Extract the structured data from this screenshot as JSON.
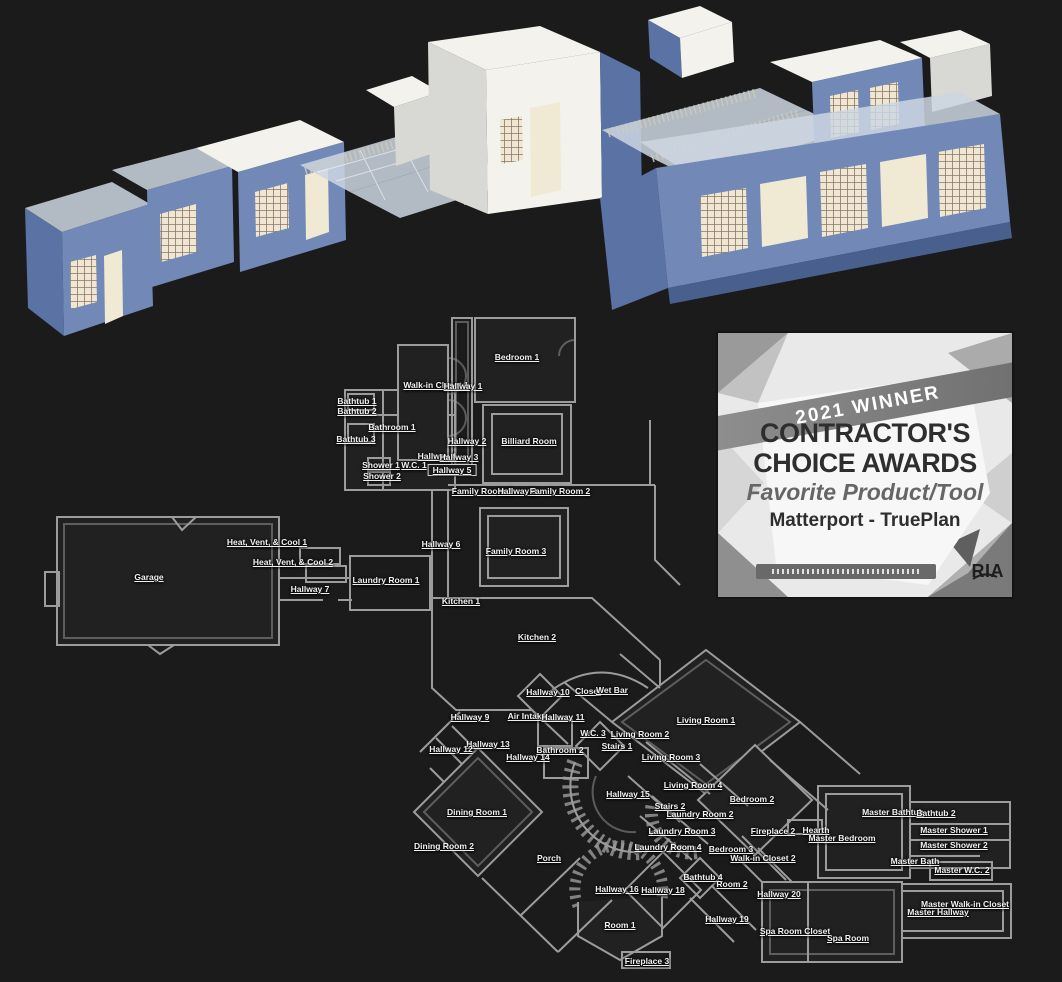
{
  "palette": {
    "bg": "#1b1b1b",
    "plan_line": "#9c9c9c",
    "label": "#f1f1f1",
    "wall_blue": "#7289b8",
    "wall_blue_dark": "#5a72a4",
    "wall_blue_deep": "#49608f",
    "roof_white": "#f3f2ec",
    "roof_glass": "#ccd6e2",
    "interior_cream": "#f0e9d4",
    "lattice_brown": "#8d7668",
    "badge_text": "#2e2e2e",
    "badge_sub": "#666666"
  },
  "badge": {
    "banner": "2021 WINNER",
    "title_line1": "CONTRACTOR'S",
    "title_line2": "CHOICE AWARDS",
    "category": "Favorite Product/Tool",
    "winner": "Matterport - TruePlan",
    "logo": "RIA"
  },
  "floorplan": {
    "labels": [
      {
        "t": "Bedroom 1",
        "x": 517,
        "y": 357
      },
      {
        "t": "Walk-in Closet 1",
        "x": 436,
        "y": 385
      },
      {
        "t": "Hallway 1",
        "x": 463,
        "y": 386
      },
      {
        "t": "Bathtub 1",
        "x": 357,
        "y": 401
      },
      {
        "t": "Bathtub 2",
        "x": 357,
        "y": 411
      },
      {
        "t": "Bathroom 1",
        "x": 392,
        "y": 427
      },
      {
        "t": "Bathtub 3",
        "x": 356,
        "y": 439
      },
      {
        "t": "Hallway 2",
        "x": 467,
        "y": 441
      },
      {
        "t": "Billiard Room",
        "x": 529,
        "y": 441
      },
      {
        "t": "Hallway 4",
        "x": 437,
        "y": 456
      },
      {
        "t": "Hallway 3",
        "x": 459,
        "y": 457
      },
      {
        "t": "Shower 1",
        "x": 381,
        "y": 465
      },
      {
        "t": "W.C. 1",
        "x": 414,
        "y": 465
      },
      {
        "t": "Hallway 5",
        "x": 452,
        "y": 470,
        "b": true
      },
      {
        "t": "Shower 2",
        "x": 382,
        "y": 476
      },
      {
        "t": "Family Room 1",
        "x": 482,
        "y": 491
      },
      {
        "t": "Hallway 8",
        "x": 517,
        "y": 491
      },
      {
        "t": "Family Room 2",
        "x": 560,
        "y": 491
      },
      {
        "t": "Heat, Vent, & Cool 1",
        "x": 267,
        "y": 542
      },
      {
        "t": "Hallway 6",
        "x": 441,
        "y": 544
      },
      {
        "t": "Family Room 3",
        "x": 516,
        "y": 551
      },
      {
        "t": "Heat, Vent, & Cool 2",
        "x": 293,
        "y": 562
      },
      {
        "t": "Garage",
        "x": 149,
        "y": 577
      },
      {
        "t": "Laundry Room 1",
        "x": 386,
        "y": 580
      },
      {
        "t": "Hallway 7",
        "x": 310,
        "y": 589
      },
      {
        "t": "Kitchen 1",
        "x": 461,
        "y": 601
      },
      {
        "t": "Kitchen 2",
        "x": 537,
        "y": 637
      },
      {
        "t": "Hallway 10",
        "x": 548,
        "y": 692
      },
      {
        "t": "Closet",
        "x": 588,
        "y": 691
      },
      {
        "t": "Wet Bar",
        "x": 612,
        "y": 690
      },
      {
        "t": "Hallway 9",
        "x": 470,
        "y": 717
      },
      {
        "t": "Air Intake",
        "x": 527,
        "y": 716
      },
      {
        "t": "Hallway 11",
        "x": 563,
        "y": 717
      },
      {
        "t": "Living Room 1",
        "x": 706,
        "y": 720
      },
      {
        "t": "W.C. 3",
        "x": 593,
        "y": 733
      },
      {
        "t": "Living Room 2",
        "x": 640,
        "y": 734
      },
      {
        "t": "Hallway 13",
        "x": 488,
        "y": 744
      },
      {
        "t": "Stairs 1",
        "x": 617,
        "y": 746
      },
      {
        "t": "Hallway 12",
        "x": 451,
        "y": 749
      },
      {
        "t": "Bathroom 2",
        "x": 560,
        "y": 750
      },
      {
        "t": "Hallway 14",
        "x": 528,
        "y": 757
      },
      {
        "t": "Living Room 3",
        "x": 671,
        "y": 757
      },
      {
        "t": "Living Room 4",
        "x": 693,
        "y": 785
      },
      {
        "t": "Hallway 15",
        "x": 628,
        "y": 794
      },
      {
        "t": "Bedroom 2",
        "x": 752,
        "y": 799
      },
      {
        "t": "Stairs 2",
        "x": 670,
        "y": 806
      },
      {
        "t": "Dining Room 1",
        "x": 477,
        "y": 812
      },
      {
        "t": "Master Bathtub",
        "x": 893,
        "y": 812
      },
      {
        "t": "Bathtub 2",
        "x": 936,
        "y": 813
      },
      {
        "t": "Laundry Room 2",
        "x": 700,
        "y": 814
      },
      {
        "t": "Master Shower 1",
        "x": 954,
        "y": 830
      },
      {
        "t": "Fireplace 2",
        "x": 773,
        "y": 831
      },
      {
        "t": "Hearth",
        "x": 816,
        "y": 830
      },
      {
        "t": "Laundry Room 3",
        "x": 682,
        "y": 831
      },
      {
        "t": "Master Bedroom",
        "x": 842,
        "y": 838
      },
      {
        "t": "Master Shower 2",
        "x": 954,
        "y": 845
      },
      {
        "t": "Dining Room 2",
        "x": 444,
        "y": 846
      },
      {
        "t": "Laundry Room 4",
        "x": 668,
        "y": 847
      },
      {
        "t": "Bedroom 3",
        "x": 731,
        "y": 849
      },
      {
        "t": "Porch",
        "x": 549,
        "y": 858
      },
      {
        "t": "Walk-in Closet 2",
        "x": 763,
        "y": 858
      },
      {
        "t": "Master Bath",
        "x": 915,
        "y": 861
      },
      {
        "t": "Master W.C. 2",
        "x": 962,
        "y": 870
      },
      {
        "t": "Bathtub 4",
        "x": 703,
        "y": 877
      },
      {
        "t": "Room 2",
        "x": 732,
        "y": 884
      },
      {
        "t": "Hallway 16",
        "x": 617,
        "y": 889
      },
      {
        "t": "Hallway 18",
        "x": 663,
        "y": 890
      },
      {
        "t": "Hallway 20",
        "x": 779,
        "y": 894
      },
      {
        "t": "Master Walk-in Closet",
        "x": 965,
        "y": 904
      },
      {
        "t": "Master Hallway",
        "x": 938,
        "y": 912
      },
      {
        "t": "Hallway 19",
        "x": 727,
        "y": 919
      },
      {
        "t": "Room 1",
        "x": 620,
        "y": 925
      },
      {
        "t": "Spa Room Closet",
        "x": 795,
        "y": 931
      },
      {
        "t": "Spa Room",
        "x": 848,
        "y": 938
      },
      {
        "t": "Fireplace 3",
        "x": 647,
        "y": 961
      }
    ]
  }
}
